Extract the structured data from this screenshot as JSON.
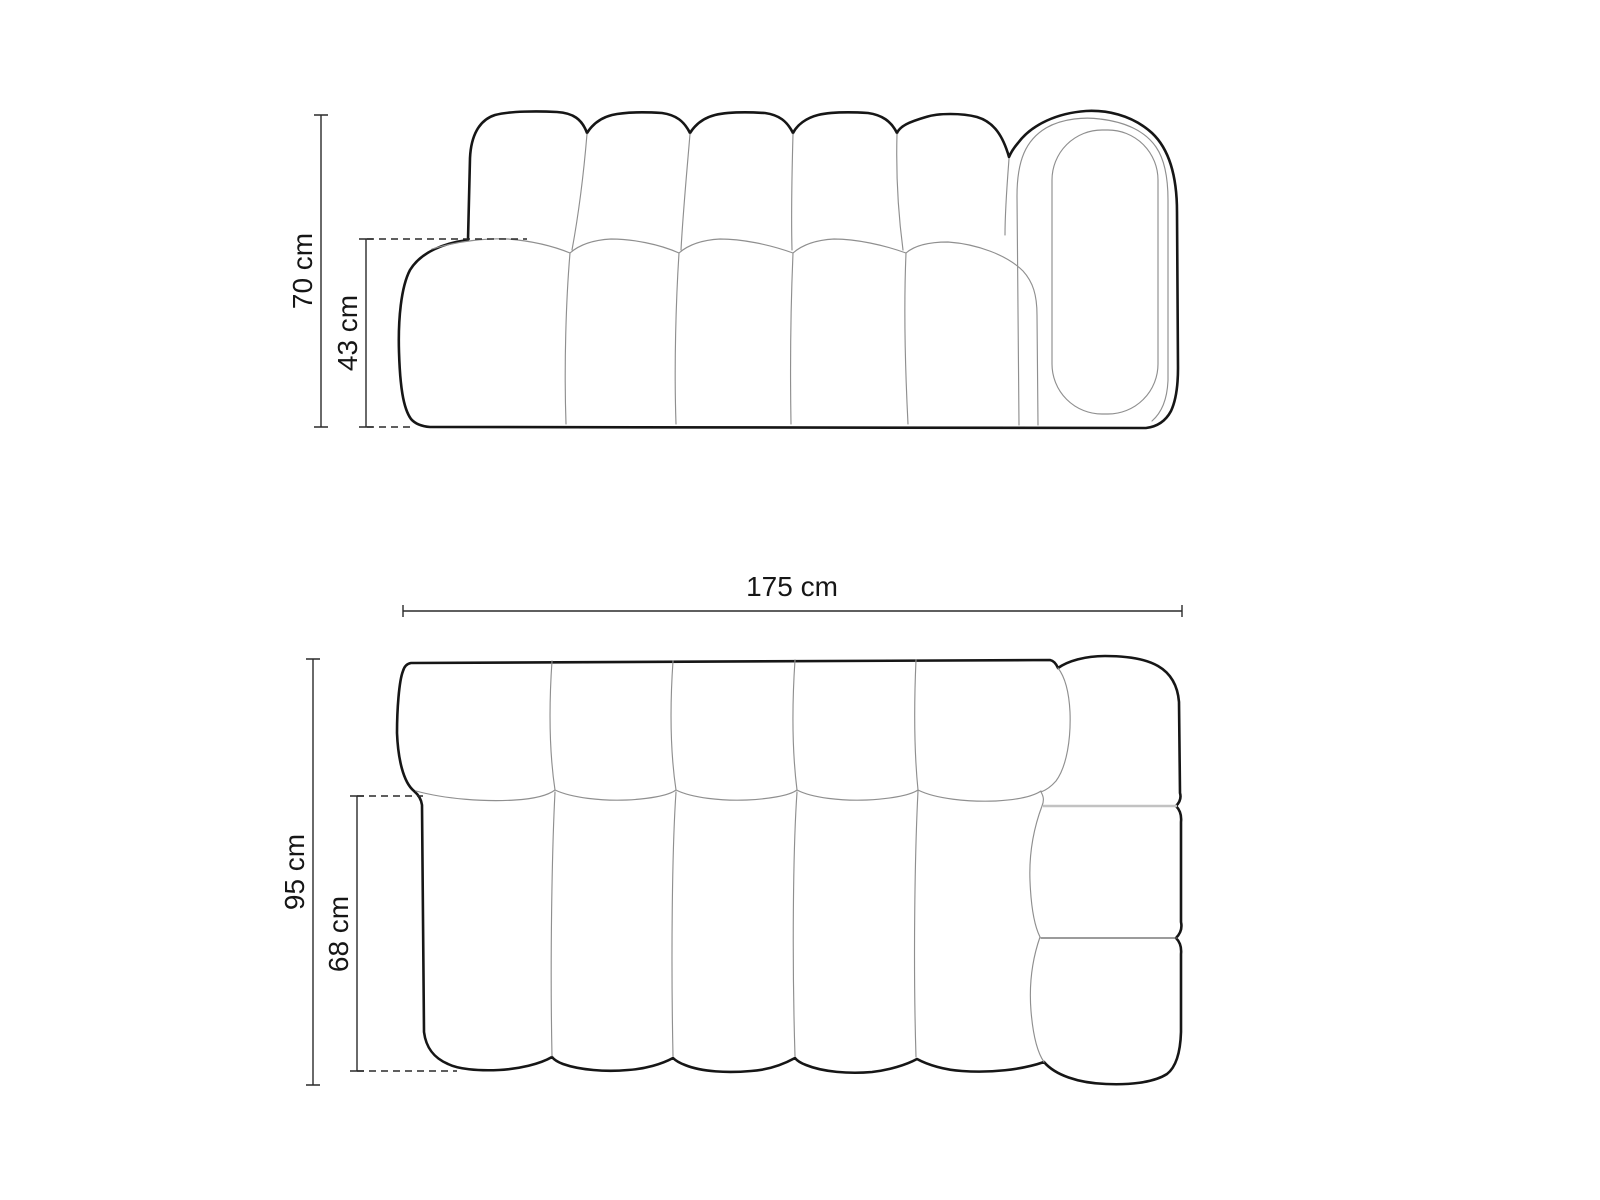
{
  "diagram": {
    "type": "furniture-dimension-drawing",
    "subject": "modular bubble sofa with right armrest",
    "front_view": {
      "name": "front elevation",
      "dimensions": {
        "total_height": {
          "label": "70 cm",
          "value": 70,
          "unit": "cm"
        },
        "seat_height": {
          "label": "43 cm",
          "value": 43,
          "unit": "cm"
        }
      },
      "back_cushions": 5,
      "seat_cushions": 4
    },
    "plan_view": {
      "name": "top plan view",
      "dimensions": {
        "total_width": {
          "label": "175 cm",
          "value": 175,
          "unit": "cm"
        },
        "total_depth": {
          "label": "95 cm",
          "value": 95,
          "unit": "cm"
        },
        "seat_depth": {
          "label": "68 cm",
          "value": 68,
          "unit": "cm"
        }
      },
      "seat_columns": 5,
      "armrest_segments": 3
    },
    "colors": {
      "background": "#ffffff",
      "outline": "#161616",
      "seam": "#8f8f8f",
      "dimension_line": "#2a2a2a",
      "armrest_divider_light": "#c2c2c2"
    }
  }
}
